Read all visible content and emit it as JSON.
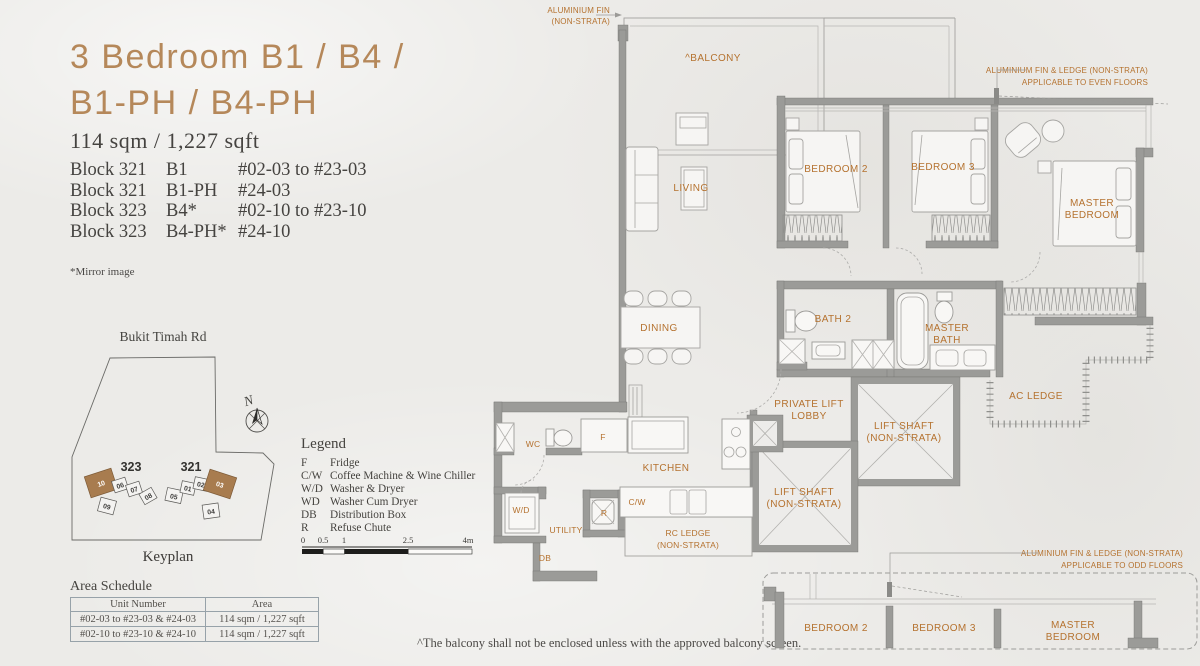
{
  "page": {
    "title_line1": "3 Bedroom B1 / B4 /",
    "title_line2": "B1-PH / B4-PH",
    "area_summary": "114 sqm / 1,227 sqft",
    "mirror_note": "*Mirror image",
    "footnote": "^The balcony shall not be enclosed unless with the approved balcony screen."
  },
  "unit_list": [
    {
      "block": "Block 321",
      "type": "B1",
      "range": "#02-03 to #23-03"
    },
    {
      "block": "Block 321",
      "type": "B1-PH",
      "range": "#24-03"
    },
    {
      "block": "Block 323",
      "type": "B4*",
      "range": "#02-10 to #23-10"
    },
    {
      "block": "Block 323",
      "type": "B4-PH*",
      "range": "#24-10"
    }
  ],
  "keyplan": {
    "road_label": "Bukit Timah Rd",
    "caption": "Keyplan",
    "north_label": "N",
    "block_323": {
      "name": "323",
      "units": [
        "10",
        "06",
        "07",
        "08",
        "09"
      ]
    },
    "block_321": {
      "name": "321",
      "units": [
        "05",
        "01",
        "02",
        "03",
        "04"
      ]
    },
    "highlighted_units": [
      "10",
      "03"
    ]
  },
  "legend": {
    "title": "Legend",
    "items": [
      {
        "key": "F",
        "desc": "Fridge"
      },
      {
        "key": "C/W",
        "desc": "Coffee Machine & Wine Chiller"
      },
      {
        "key": "W/D",
        "desc": "Washer & Dryer"
      },
      {
        "key": "WD",
        "desc": "Washer Cum Dryer"
      },
      {
        "key": "DB",
        "desc": "Distribution Box"
      },
      {
        "key": "R",
        "desc": "Refuse Chute"
      }
    ],
    "scale": {
      "t0": "0",
      "t1": "0.5",
      "t2": "1",
      "t3": "2.5",
      "t4": "4m"
    }
  },
  "area_schedule": {
    "title": "Area Schedule",
    "col_unit": "Unit Number",
    "col_area": "Area",
    "rows": [
      {
        "unit": "#02-03 to #23-03 & #24-03",
        "area": "114 sqm / 1,227 sqft"
      },
      {
        "unit": "#02-10 to #23-10 & #24-10",
        "area": "114 sqm / 1,227 sqft"
      }
    ]
  },
  "plan": {
    "rooms": {
      "balcony": "^BALCONY",
      "living": "LIVING",
      "dining": "DINING",
      "bedroom2": "BEDROOM 2",
      "bedroom3": "BEDROOM 3",
      "master_l1": "MASTER",
      "master_l2": "BEDROOM",
      "bath2": "BATH 2",
      "master_bath_l1": "MASTER",
      "master_bath_l2": "BATH",
      "ac_ledge": "AC LEDGE",
      "private_lift_l1": "PRIVATE LIFT",
      "private_lift_l2": "LOBBY",
      "lift_shaft_l1": "LIFT SHAFT",
      "lift_shaft_l2": "(NON-STRATA)",
      "kitchen": "KITCHEN",
      "wc": "WC",
      "rc_ledge_l1": "RC LEDGE",
      "rc_ledge_l2": "(NON-STRATA)",
      "utility": "UTILITY",
      "f": "F",
      "cw": "C/W",
      "wd": "W/D",
      "db": "DB",
      "r": "R"
    },
    "annotations": {
      "fin_l1": "ALUMINIUM FIN",
      "fin_l2": "(NON-STRATA)",
      "fin_even_l1": "ALUMINIUM FIN & LEDGE (NON-STRATA)",
      "fin_even_l2": "APPLICABLE TO EVEN FLOORS",
      "fin_odd_l1": "ALUMINIUM FIN & LEDGE (NON-STRATA)",
      "fin_odd_l2": "APPLICABLE TO ODD FLOORS"
    },
    "lower_section": {
      "bedroom2": "BEDROOM 2",
      "bedroom3": "BEDROOM 3",
      "master_l1": "MASTER",
      "master_l2": "BEDROOM"
    }
  },
  "colors": {
    "accent_tan": "#b5885a",
    "plan_label_orange": "#b5722f",
    "wall_gray": "#9b9b98",
    "text_dark": "#454340",
    "keyplan_highlight": "#a87c4f",
    "background": "#ecebe8"
  }
}
